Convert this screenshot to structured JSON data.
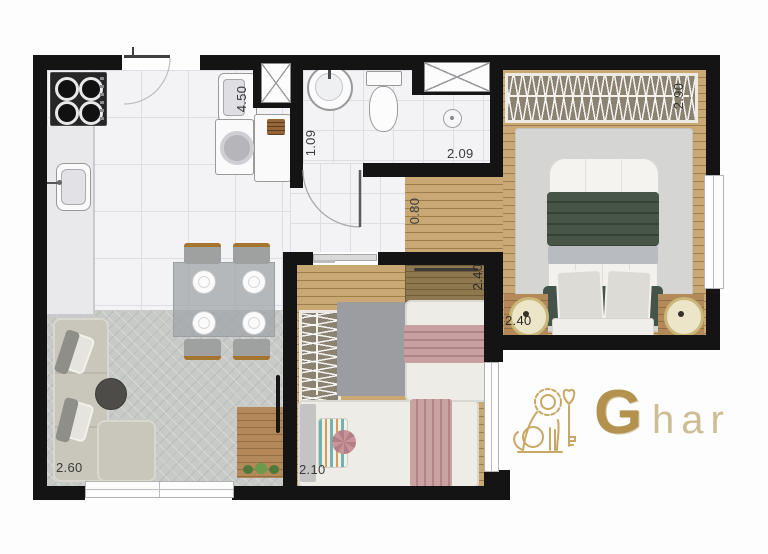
{
  "plan": {
    "labels": {
      "laundry": "4.50",
      "bath_width": "1.09",
      "bath_length": "2.09",
      "hall": "0.80",
      "master_length": "2.90",
      "master_width": "2.40",
      "bedroom2_length": "2.40",
      "bedroom2_width": "2.10",
      "living": "2.60"
    },
    "logo": {
      "initial": "G",
      "rest": "har"
    },
    "colors": {
      "wall": "#141414",
      "wood_floor": "#c9a873",
      "brand_gold": "#b3924e",
      "master_bed_green": "#475548",
      "single_bed_pink": "#c8a0a1"
    }
  }
}
